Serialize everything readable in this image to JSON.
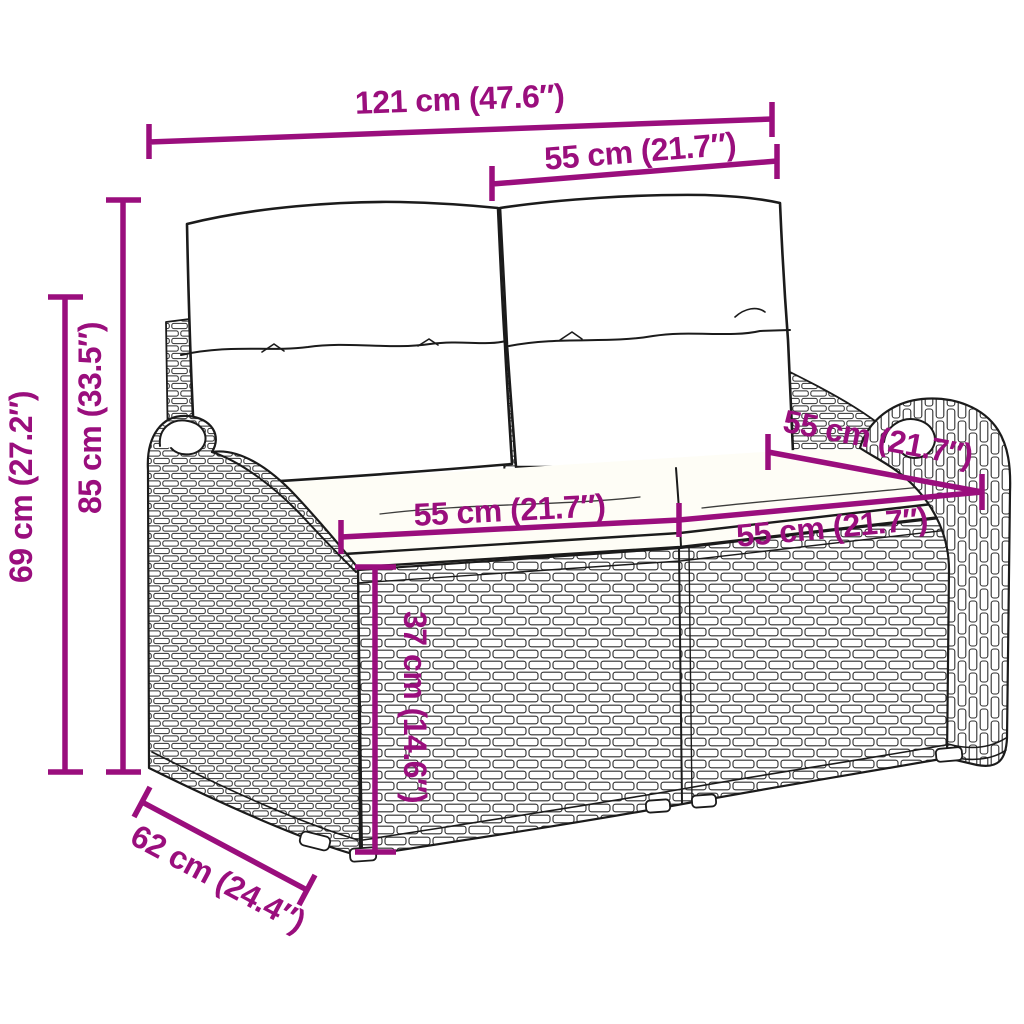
{
  "diagram": {
    "type": "product-dimension-diagram",
    "subject": "two-seater poly rattan garden bench with back and seat cushions",
    "background_color": "#ffffff",
    "line_color": "#1b1b1b",
    "dimension_color": "#9a0e7d",
    "dimensions": {
      "overall_width": "121 cm (47.6″)",
      "backrest_section_width": "55 cm (21.7″)",
      "total_height": "85 cm (33.5″)",
      "armrest_height": "69 cm (27.2″)",
      "seat_depth": "55 cm (21.7″)",
      "left_seat_width": "55 cm (21.7″)",
      "right_seat_width": "55 cm (21.7″)",
      "seat_height": "37 cm (14.6″)",
      "overall_depth": "62 cm (24.4″)"
    }
  }
}
